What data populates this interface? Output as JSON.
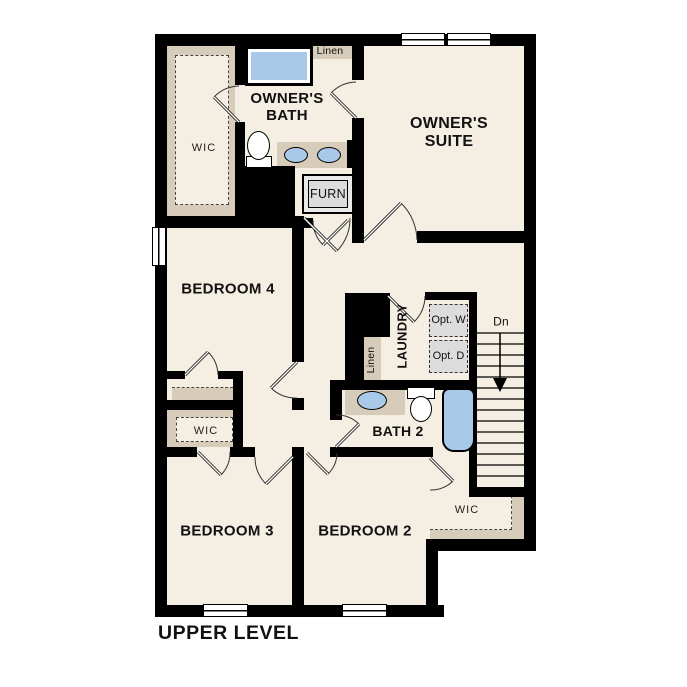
{
  "title": "UPPER LEVEL",
  "rooms": {
    "owners_bath": "OWNER'S BATH",
    "owners_suite": "OWNER'S SUITE",
    "bedroom4": "BEDROOM 4",
    "bedroom3": "BEDROOM 3",
    "bedroom2": "BEDROOM 2",
    "bath2": "BATH 2",
    "laundry": "LAUNDRY",
    "wic_owner": "WIC",
    "wic_bedroom3": "WIC",
    "wic_bedroom2": "WIC"
  },
  "closets": {
    "linen_top": "Linen",
    "linen_hall": "Linen"
  },
  "labels": {
    "furnace": "FURN",
    "opt_washer": "Opt. W",
    "opt_dryer": "Opt. D",
    "stairs_down": "Dn"
  },
  "colors": {
    "floor": "#F5EFE3",
    "closet": "#D6CCB9",
    "fixture_blue": "#A9C9E8",
    "wall": "#000000",
    "equipment_gray": "#DCDCDC"
  }
}
